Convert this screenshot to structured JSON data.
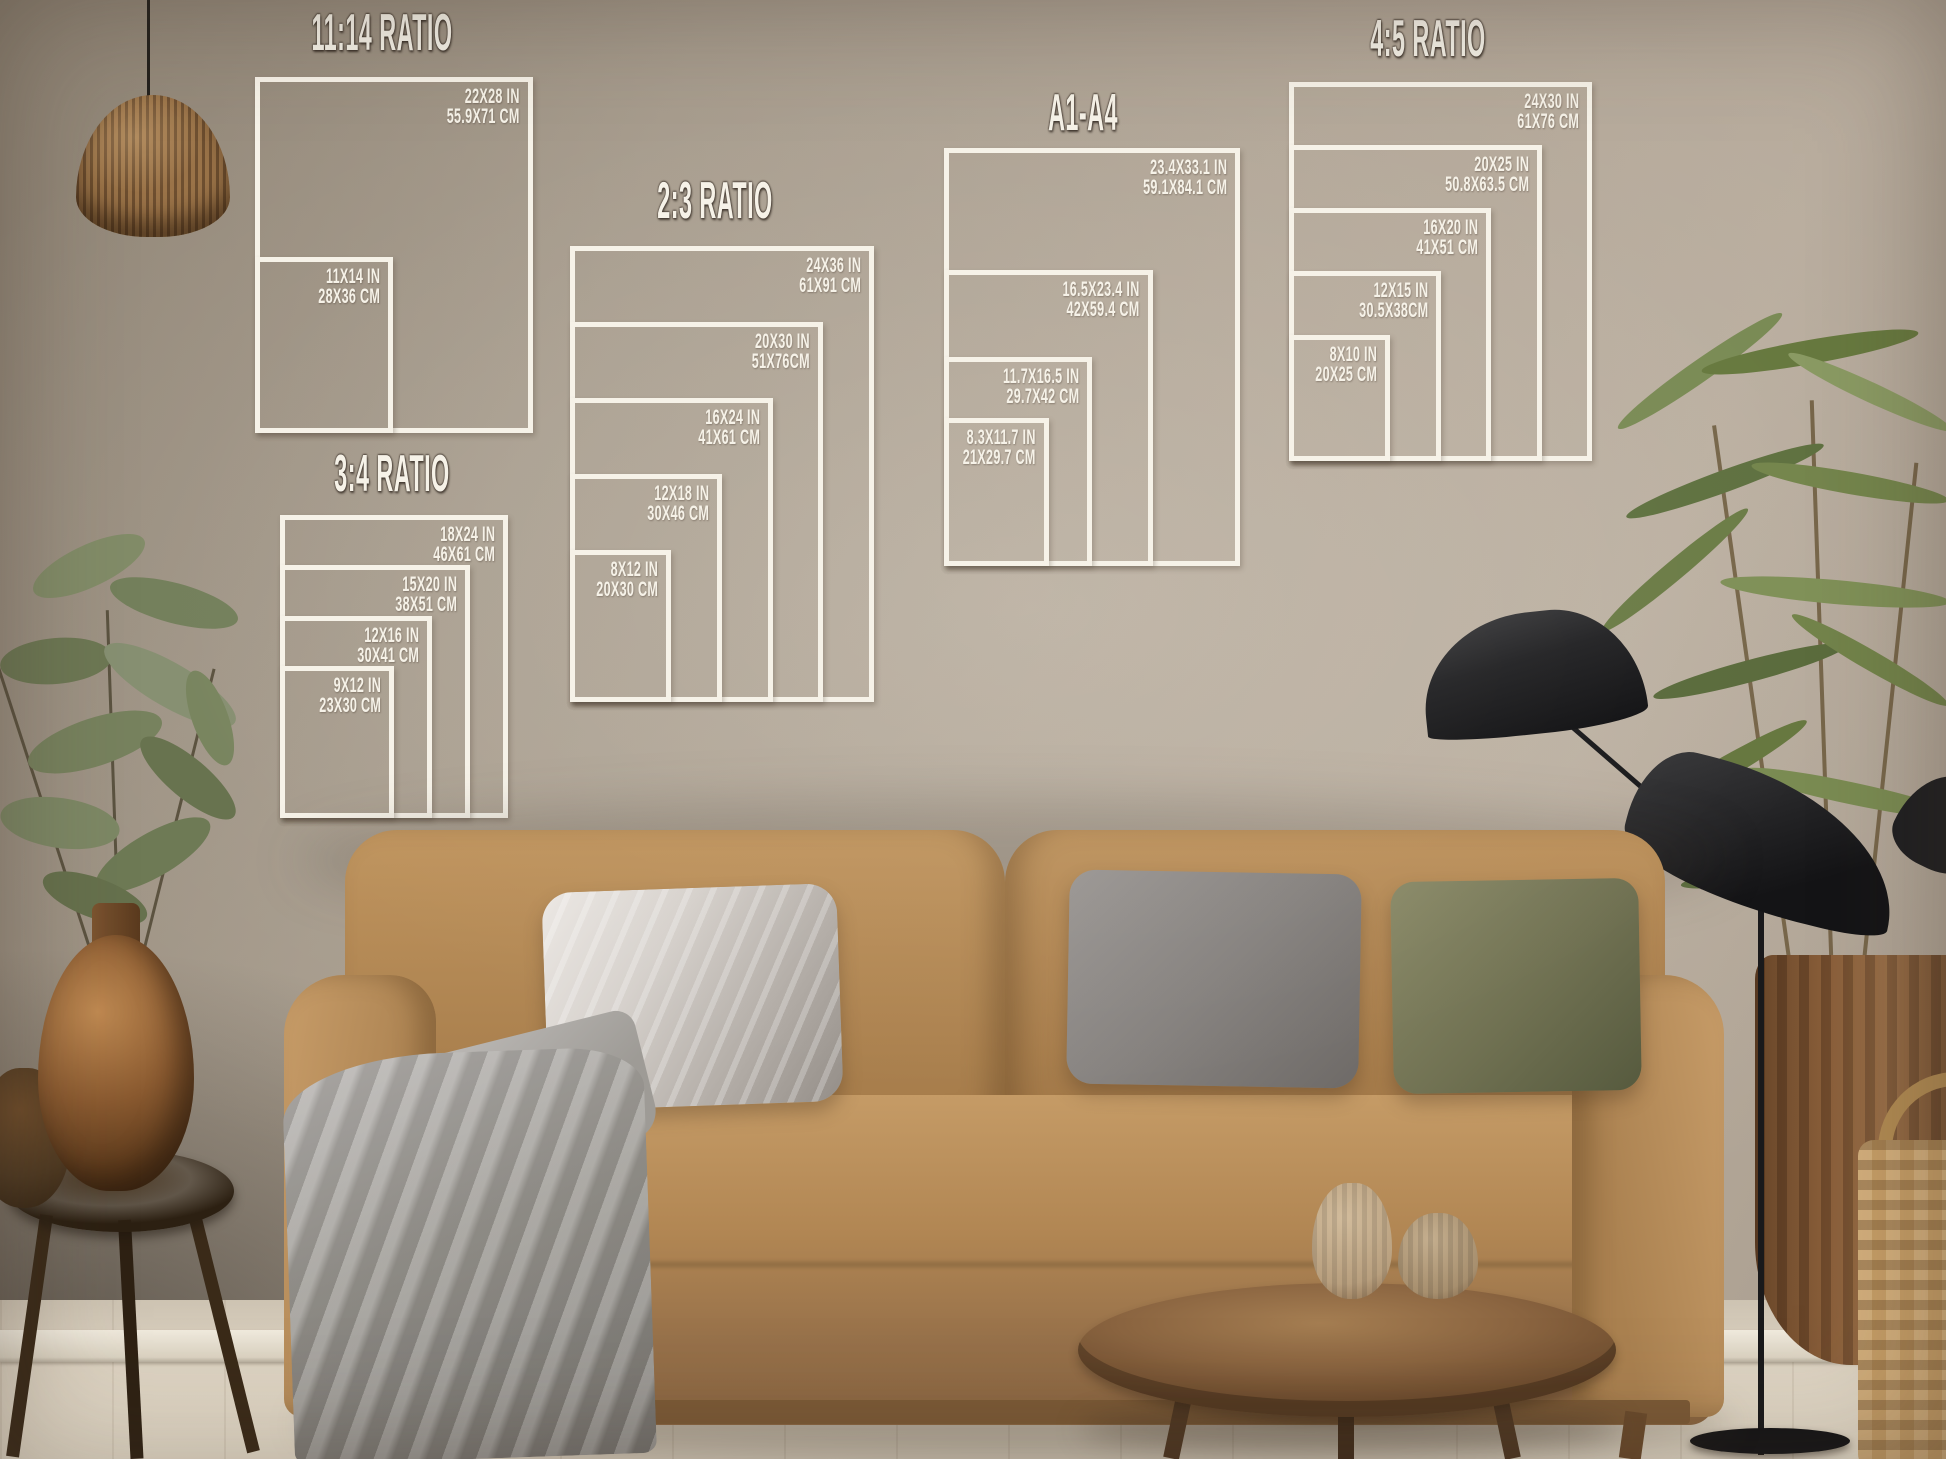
{
  "guide": {
    "frame_color": "#f6f2e8",
    "title_color": "#f6f2e8",
    "groups": [
      {
        "id": "ratio-11-14",
        "title": "11:14 RATIO",
        "sizes": [
          {
            "in": "22X28 IN",
            "cm": "55.9X71 CM"
          },
          {
            "in": "11X14 IN",
            "cm": "28X36 CM"
          }
        ]
      },
      {
        "id": "ratio-2-3",
        "title": "2:3 RATIO",
        "sizes": [
          {
            "in": "24X36 IN",
            "cm": "61X91 CM"
          },
          {
            "in": "20X30 IN",
            "cm": "51X76CM"
          },
          {
            "in": "16X24 IN",
            "cm": "41X61 CM"
          },
          {
            "in": "12X18 IN",
            "cm": "30X46 CM"
          },
          {
            "in": "8X12 IN",
            "cm": "20X30 CM"
          }
        ]
      },
      {
        "id": "a1-a4",
        "title": "A1-A4",
        "sizes": [
          {
            "in": "23.4X33.1 IN",
            "cm": "59.1X84.1 CM"
          },
          {
            "in": "16.5X23.4 IN",
            "cm": "42X59.4 CM"
          },
          {
            "in": "11.7X16.5 IN",
            "cm": "29.7X42 CM"
          },
          {
            "in": "8.3X11.7 IN",
            "cm": "21X29.7 CM"
          }
        ]
      },
      {
        "id": "ratio-4-5",
        "title": "4:5 RATIO",
        "sizes": [
          {
            "in": "24X30 IN",
            "cm": "61X76 CM"
          },
          {
            "in": "20X25 IN",
            "cm": "50.8X63.5 CM"
          },
          {
            "in": "16X20 IN",
            "cm": "41X51 CM"
          },
          {
            "in": "12X15 IN",
            "cm": "30.5X38CM"
          },
          {
            "in": "8X10 IN",
            "cm": "20X25 CM"
          }
        ]
      },
      {
        "id": "ratio-3-4",
        "title": "3:4 RATIO",
        "sizes": [
          {
            "in": "18X24 IN",
            "cm": "46X61 CM"
          },
          {
            "in": "15X20 IN",
            "cm": "38X51 CM"
          },
          {
            "in": "12X16 IN",
            "cm": "30X41 CM"
          },
          {
            "in": "9X12 IN",
            "cm": "23X30 CM"
          }
        ]
      }
    ]
  },
  "scene_colors": {
    "wall": "#ab9f90",
    "floor": "#ddd3c3",
    "sofa": "#b68a58",
    "pillow_silver": "#cfc9c3",
    "pillow_gray": "#8b8784",
    "pillow_olive": "#72745a",
    "blanket": "#9b9896",
    "wood": "#8a6440",
    "lamp_black": "#1c1c1e",
    "plant_green": "#6f7f4e",
    "bronze": "#8a5a30",
    "basket": "#c59d66"
  }
}
